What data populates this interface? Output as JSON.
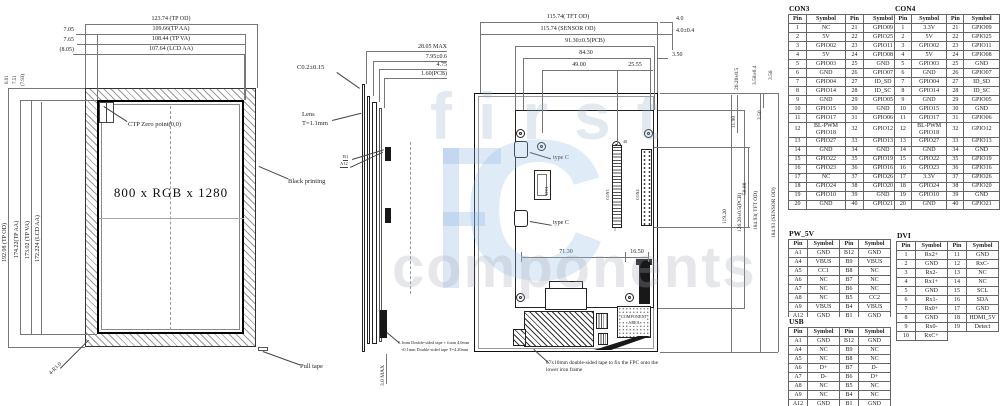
{
  "watermark": {
    "word1": "first",
    "word2": "components",
    "letter": "C"
  },
  "left_view": {
    "resolution": "800 x RGB x 1280",
    "dim_tp_od": "123.74 (TP OD)",
    "dim_tp_aa": "109.66(TP AA)",
    "dim_tp_va": "108.44 (TP VA)",
    "dim_lcd_aa": "107.64 (LCD AA)",
    "off1": "7.05",
    "off2": "7.65",
    "off3": "(8.05)",
    "voff1": "6.91",
    "voff2": "7.51",
    "voff3": "(7.93)",
    "vdim_tp_od": "192.08 (TP OD)",
    "vdim_tp_aa": "174.22(TP AA)",
    "vdim_tp_va": "173.02 (TP VA)",
    "vdim_lcd_aa": "172.224 (LCD AA)",
    "ctp_zero": "CTP Zero point(0,0)",
    "black_printing": "Black printing",
    "pull_tape": "Pull tape",
    "corner_r": "4-R1.0"
  },
  "side_view": {
    "dim1": "28.05 MAX",
    "dim2": "7.95±0.6",
    "dim3": "4.75",
    "dim4": "1.60(PCB)",
    "chamfer": "C0.2±0.15",
    "lens1": "Lens",
    "lens2": "T=1.1mm",
    "b1": "B1",
    "a12": "A12",
    "bottom_max": "3.0 MAX",
    "tape_note1": "0.1mm Double-sided tape + foam 4.0mm",
    "tape_note2": "+0.1mm Double-sided tape T=4.20mm"
  },
  "back_view": {
    "dim_tft_od": "115.74( TFT OD)",
    "dim_sensor_od": "115.74 (SENSOR  OD)",
    "dim_pcb": "91.30±0.5(PCB)",
    "dim_8430": "84.30",
    "dim_4900": "49.00",
    "dim_2555": "25.55",
    "dim_40": "4.0",
    "dim_4004": "4.0±0.4",
    "dim_350t": "3.50",
    "rot_2620": "26.20±0.5",
    "rot_358a": "3.58±0.4",
    "rot_358b": "3.58",
    "rot_1190": "11.90",
    "rot_350": "3.50",
    "rot_5800": "58.00",
    "rot_11920": "119.20",
    "rot_pcb": "126.20±0.5(PCB)",
    "rot_tft": "184.93( TFT OD)",
    "rot_sensor": "184.93 (SENSOR  OD)",
    "dim_7130": "71.30",
    "dim_1650": "16.50",
    "type_c": "type C",
    "dvi": "DVI",
    "con3": "CON3",
    "con4": "CON4",
    "pin40": "40",
    "pin1": "1",
    "component_area1": "COMPONENT",
    "component_area2": "AREA",
    "tape_note1": "67x10mm double-sided tape to fix the FPC onto the",
    "tape_note2": "lower iron frame"
  },
  "tables": {
    "con3": {
      "title": "CON3",
      "headers": [
        "Pin",
        "Symbol",
        "Pin",
        "Symbol"
      ],
      "rows": [
        [
          "1",
          "NC",
          "21",
          "GPIO09"
        ],
        [
          "2",
          "5V",
          "22",
          "GPIO25"
        ],
        [
          "3",
          "GPIO02",
          "23",
          "GPIO11"
        ],
        [
          "4",
          "5V",
          "24",
          "GPIO08"
        ],
        [
          "5",
          "GPIO03",
          "25",
          "GND"
        ],
        [
          "6",
          "GND",
          "26",
          "GPIO07"
        ],
        [
          "7",
          "GPIO04",
          "27",
          "ID_SD"
        ],
        [
          "8",
          "GPIO14",
          "28",
          "ID_SC"
        ],
        [
          "9",
          "GND",
          "29",
          "GPIO05"
        ],
        [
          "10",
          "GPIO15",
          "30",
          "GND"
        ],
        [
          "11",
          "GPIO17",
          "31",
          "GPIO06"
        ],
        [
          "12",
          "BL-PWM GPIO18",
          "32",
          "GPIO12"
        ],
        [
          "13",
          "GPIO27",
          "33",
          "GPIO13"
        ],
        [
          "14",
          "GND",
          "34",
          "GND"
        ],
        [
          "15",
          "GPIO22",
          "35",
          "GPIO19"
        ],
        [
          "16",
          "GPIO23",
          "36",
          "GPIO16"
        ],
        [
          "17",
          "NC",
          "37",
          "GPIO26"
        ],
        [
          "18",
          "GPIO24",
          "38",
          "GPIO20"
        ],
        [
          "19",
          "GPIO10",
          "39",
          "GND"
        ],
        [
          "20",
          "GND",
          "40",
          "GPIO21"
        ]
      ]
    },
    "con4": {
      "title": "CON4",
      "headers": [
        "Pin",
        "Symbol",
        "Pin",
        "Symbol"
      ],
      "rows": [
        [
          "1",
          "3.3V",
          "21",
          "GPIO09"
        ],
        [
          "2",
          "5V",
          "22",
          "GPIO25"
        ],
        [
          "3",
          "GPIO02",
          "23",
          "GPIO11"
        ],
        [
          "4",
          "5V",
          "24",
          "GPIO08"
        ],
        [
          "5",
          "GPIO03",
          "25",
          "GND"
        ],
        [
          "6",
          "GND",
          "26",
          "GPIO07"
        ],
        [
          "7",
          "GPIO04",
          "27",
          "ID_SD"
        ],
        [
          "8",
          "GPIO14",
          "28",
          "ID_SC"
        ],
        [
          "9",
          "GND",
          "29",
          "GPIO05"
        ],
        [
          "10",
          "GPIO15",
          "30",
          "GND"
        ],
        [
          "11",
          "GPIO17",
          "31",
          "GPIO06"
        ],
        [
          "12",
          "BL-PWM GPIO18",
          "32",
          "GPIO12"
        ],
        [
          "13",
          "GPIO27",
          "33",
          "GPIO13"
        ],
        [
          "14",
          "GND",
          "34",
          "GND"
        ],
        [
          "15",
          "GPIO22",
          "35",
          "GPIO19"
        ],
        [
          "16",
          "GPIO23",
          "36",
          "GPIO16"
        ],
        [
          "17",
          "3.3V",
          "37",
          "GPIO26"
        ],
        [
          "18",
          "GPIO24",
          "38",
          "GPIO20"
        ],
        [
          "19",
          "GPIO10",
          "39",
          "GND"
        ],
        [
          "20",
          "GND",
          "40",
          "GPIO21"
        ]
      ]
    },
    "pw5v": {
      "title": "PW_5V",
      "headers": [
        "Pin",
        "Symbol",
        "Pin",
        "Symbol"
      ],
      "rows": [
        [
          "A1",
          "GND",
          "B12",
          "GND"
        ],
        [
          "A4",
          "VBUS",
          "B9",
          "VBUS"
        ],
        [
          "A5",
          "CC1",
          "B8",
          "NC"
        ],
        [
          "A6",
          "NC",
          "B7",
          "NC"
        ],
        [
          "A7",
          "NC",
          "B6",
          "NC"
        ],
        [
          "A8",
          "NC",
          "B5",
          "CC2"
        ],
        [
          "A9",
          "VBUS",
          "B4",
          "VBUS"
        ],
        [
          "A12",
          "GND",
          "B1",
          "GND"
        ]
      ]
    },
    "usb": {
      "title": "USB",
      "headers": [
        "Pin",
        "Symbol",
        "Pin",
        "Symbol"
      ],
      "rows": [
        [
          "A1",
          "GND",
          "B12",
          "GND"
        ],
        [
          "A4",
          "NC",
          "B9",
          "NC"
        ],
        [
          "A5",
          "NC",
          "B8",
          "NC"
        ],
        [
          "A6",
          "D+",
          "B7",
          "D-"
        ],
        [
          "A7",
          "D-",
          "B6",
          "D+"
        ],
        [
          "A8",
          "NC",
          "B5",
          "NC"
        ],
        [
          "A9",
          "NC",
          "B4",
          "NC"
        ],
        [
          "A12",
          "GND",
          "B1",
          "GND"
        ]
      ]
    },
    "dvi": {
      "title": "DVI",
      "headers": [
        "Pin",
        "Symbol",
        "Pin",
        "Symbol"
      ],
      "rows": [
        [
          "1",
          "Rx2+",
          "11",
          "GND"
        ],
        [
          "2",
          "GND",
          "12",
          "RxC-"
        ],
        [
          "3",
          "Rx2-",
          "13",
          "NC"
        ],
        [
          "4",
          "Rx1+",
          "14",
          "NC"
        ],
        [
          "5",
          "GND",
          "15",
          "SCL"
        ],
        [
          "6",
          "Rx1-",
          "16",
          "SDA"
        ],
        [
          "7",
          "Rx0+",
          "17",
          "GND"
        ],
        [
          "8",
          "GND",
          "18",
          "HDMI_5V"
        ],
        [
          "9",
          "Rx0-",
          "19",
          "Detect"
        ],
        [
          "10",
          "RxC+",
          null,
          null
        ]
      ]
    }
  }
}
